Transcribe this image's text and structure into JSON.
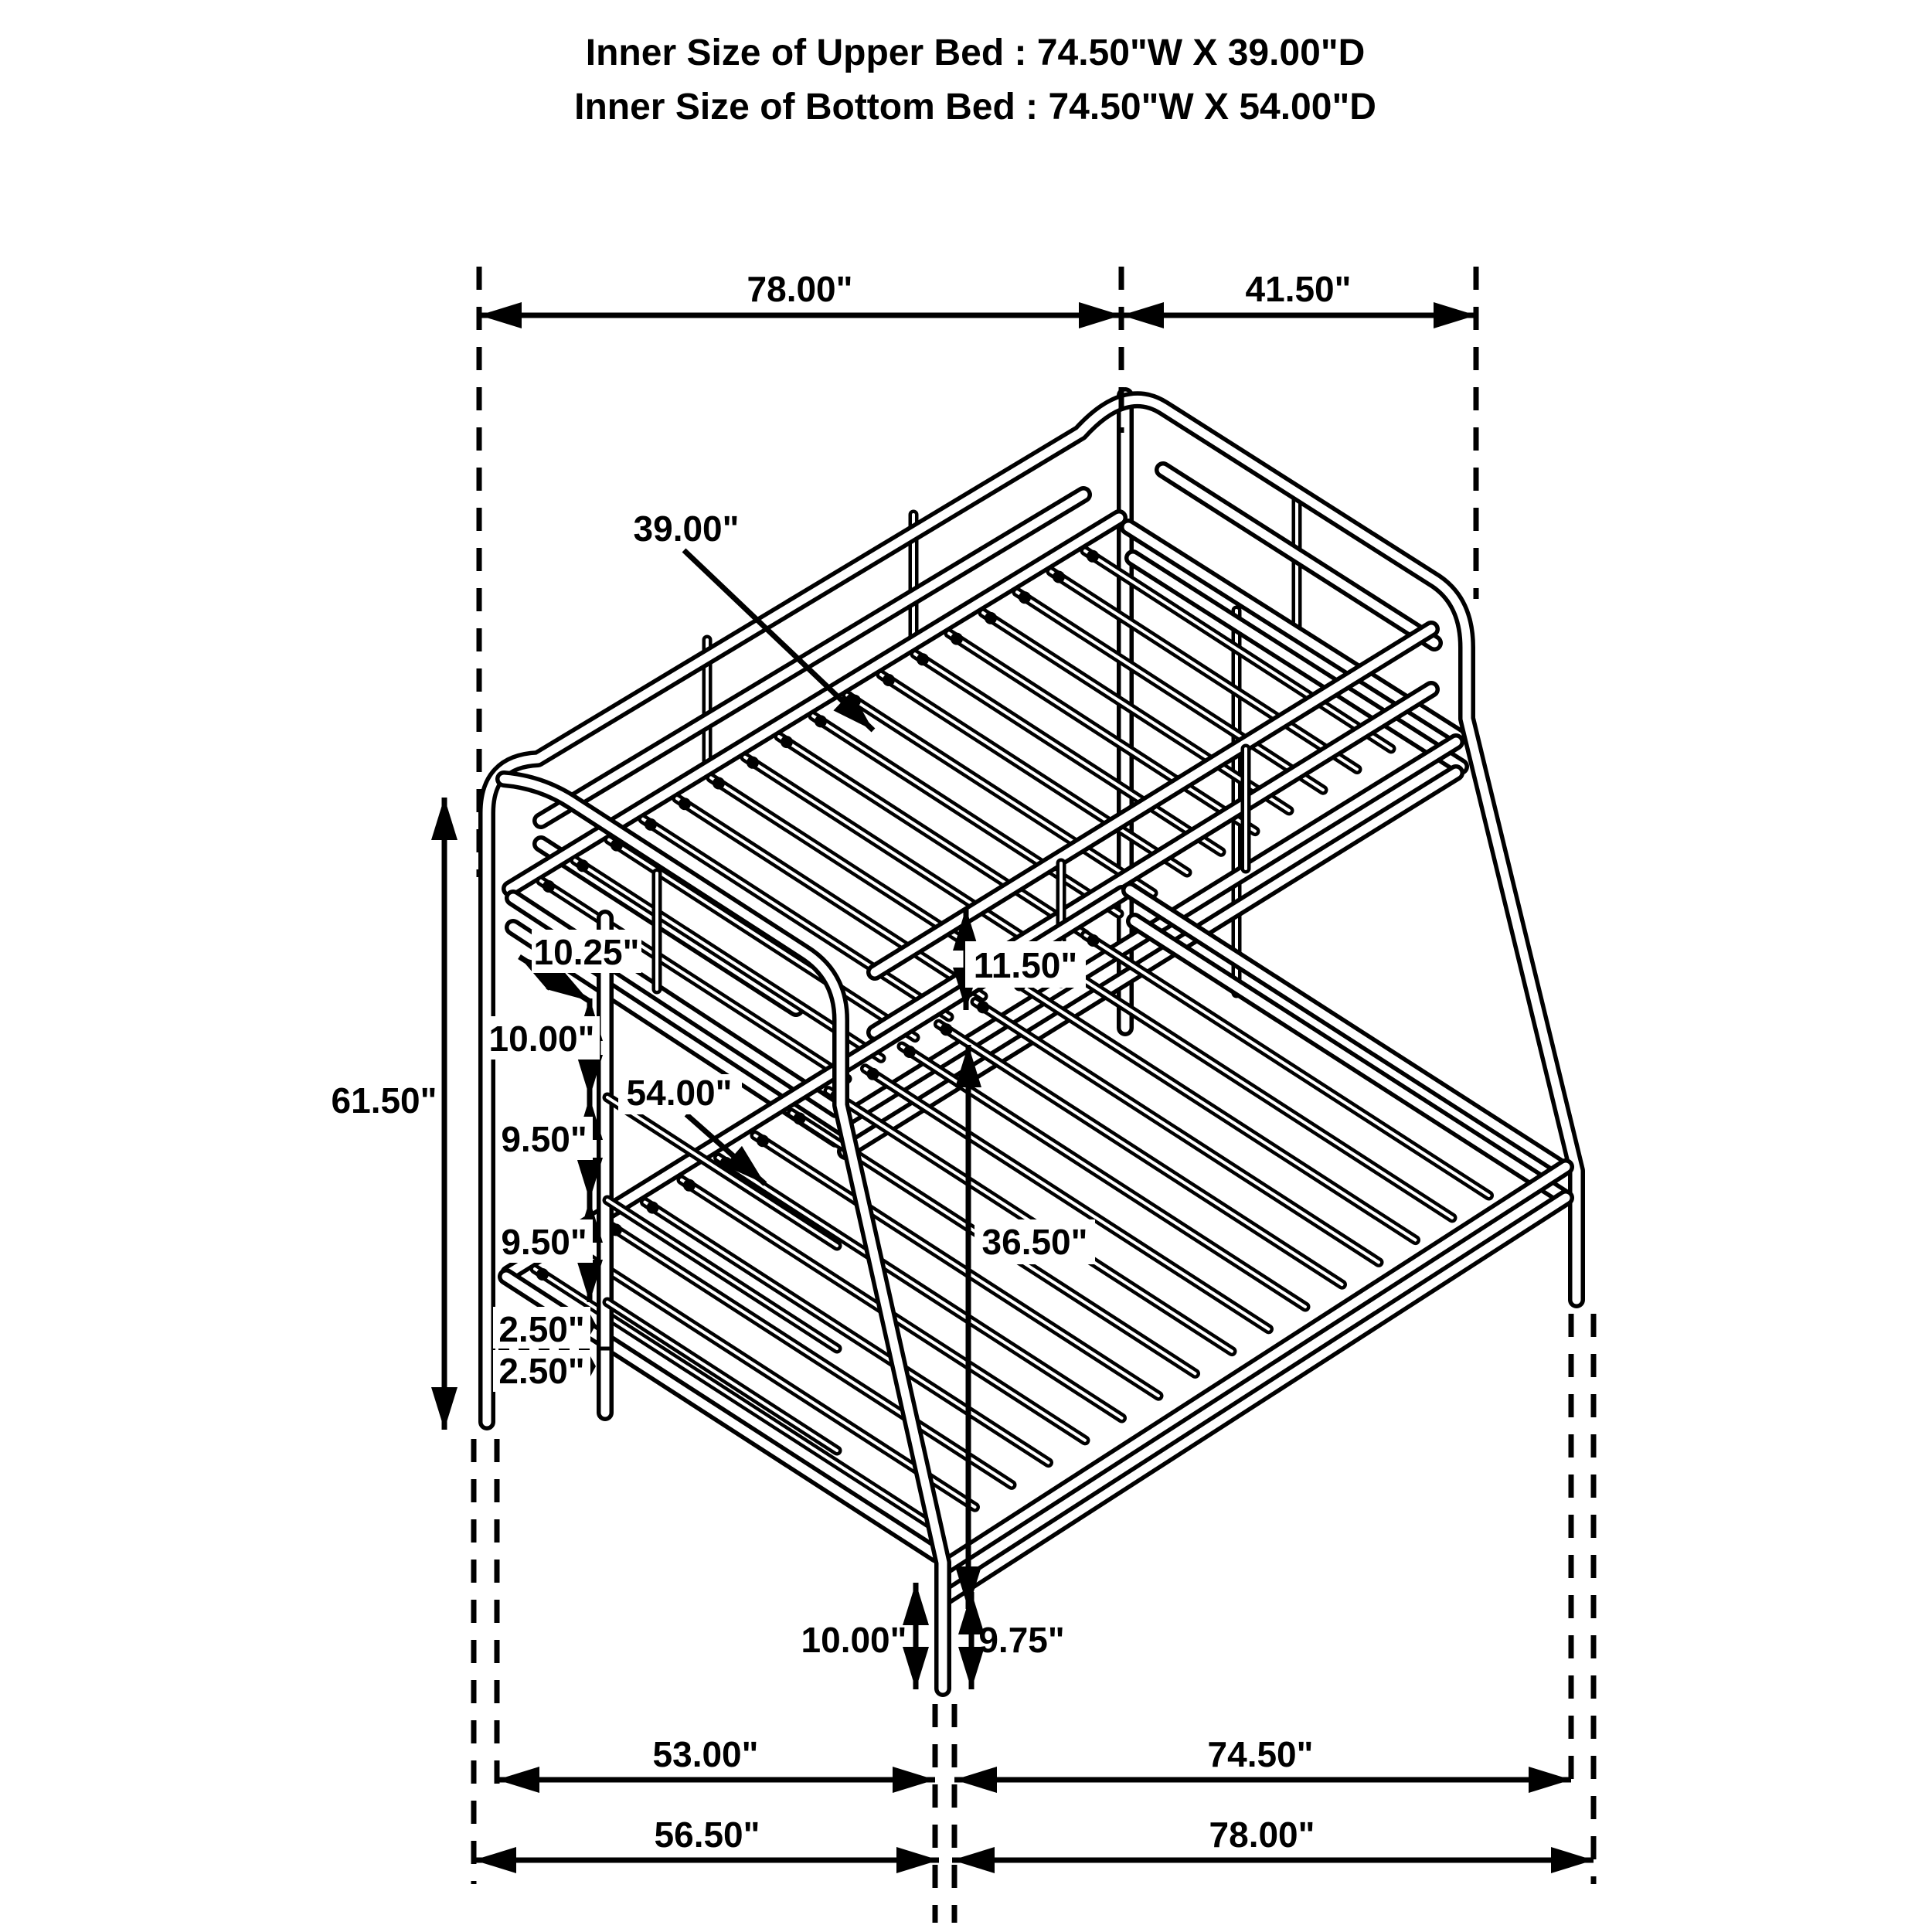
{
  "title": {
    "line1": "Inner Size of Upper Bed : 74.50\"W X 39.00\"D",
    "line2": "Inner Size of Bottom Bed : 74.50\"W X 54.00\"D"
  },
  "colors": {
    "line": "#000000",
    "background": "#ffffff"
  },
  "dimensions": {
    "top_length": "78.00\"",
    "top_depth": "41.50\"",
    "upper_bed_depth": "39.00\"",
    "ladder_top_offset": "10.25\"",
    "ladder_gap_1": "10.00\"",
    "ladder_gap_2": "9.50\"",
    "ladder_gap_3": "9.50\"",
    "ladder_gap_4": "2.50\"",
    "ladder_gap_5": "2.50\"",
    "overall_height": "61.50\"",
    "lower_bed_depth": "54.00\"",
    "guard_rail_height": "11.50\"",
    "under_bunk_clearance": "36.50\"",
    "front_leg_height": "10.00\"",
    "front_leg_height_rear": "9.75\"",
    "floor_depth_span": "53.00\"",
    "floor_length_span": "74.50\"",
    "floor_depth_overall": "56.50\"",
    "floor_length_overall": "78.00\""
  }
}
